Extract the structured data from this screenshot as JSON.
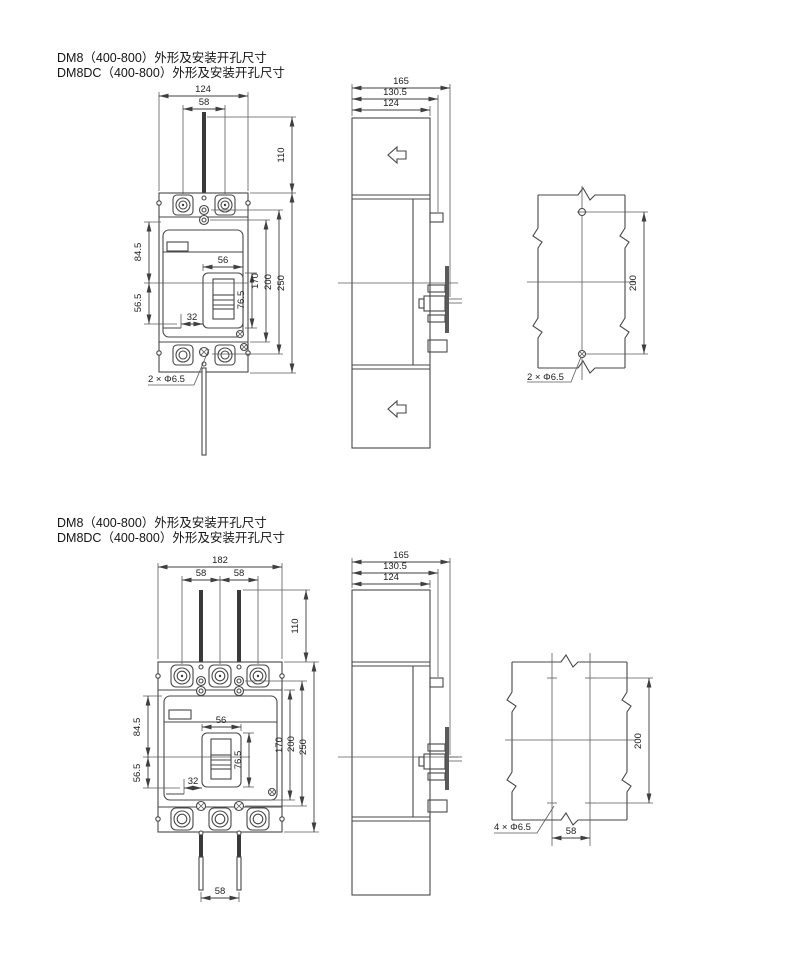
{
  "page": {
    "background": "#ffffff"
  },
  "sections": [
    {
      "title_line1": "DM8（400-800）外形及安装开孔尺寸",
      "title_line2": "DM8DC（400-800）外形及安装开孔尺寸",
      "front_view": {
        "width_total": "124",
        "terminal_pitch": "58",
        "bar_height": "110",
        "upper_height": "84.5",
        "lower_height": "56.5",
        "handle_width": "56",
        "handle_height": "76.5",
        "handle_offset": "32",
        "height_170": "170",
        "height_200": "200",
        "height_250": "250",
        "mounting_hole_label": "2 × Φ6.5"
      },
      "side_view": {
        "depth_total": "165",
        "depth_mid": "130.5",
        "depth_body": "124"
      },
      "drill_pattern": {
        "hole_spacing_vertical": "200",
        "hole_label": "2 × Φ6.5"
      }
    },
    {
      "title_line1": "DM8（400-800）外形及安装开孔尺寸",
      "title_line2": "DM8DC（400-800）外形及安装开孔尺寸",
      "front_view": {
        "width_total": "182",
        "terminal_pitch_1": "58",
        "terminal_pitch_2": "58",
        "bar_height": "110",
        "upper_height": "84.5",
        "lower_height": "56.5",
        "handle_width": "56",
        "handle_height": "76.5",
        "handle_offset": "32",
        "height_170": "170",
        "height_200": "200",
        "height_250": "250",
        "bottom_bar_pitch": "58"
      },
      "side_view": {
        "depth_total": "165",
        "depth_mid": "130.5",
        "depth_body": "124"
      },
      "drill_pattern": {
        "hole_spacing_vertical": "200",
        "hole_spacing_horizontal": "58",
        "hole_label": "4 × Φ6.5"
      }
    }
  ]
}
